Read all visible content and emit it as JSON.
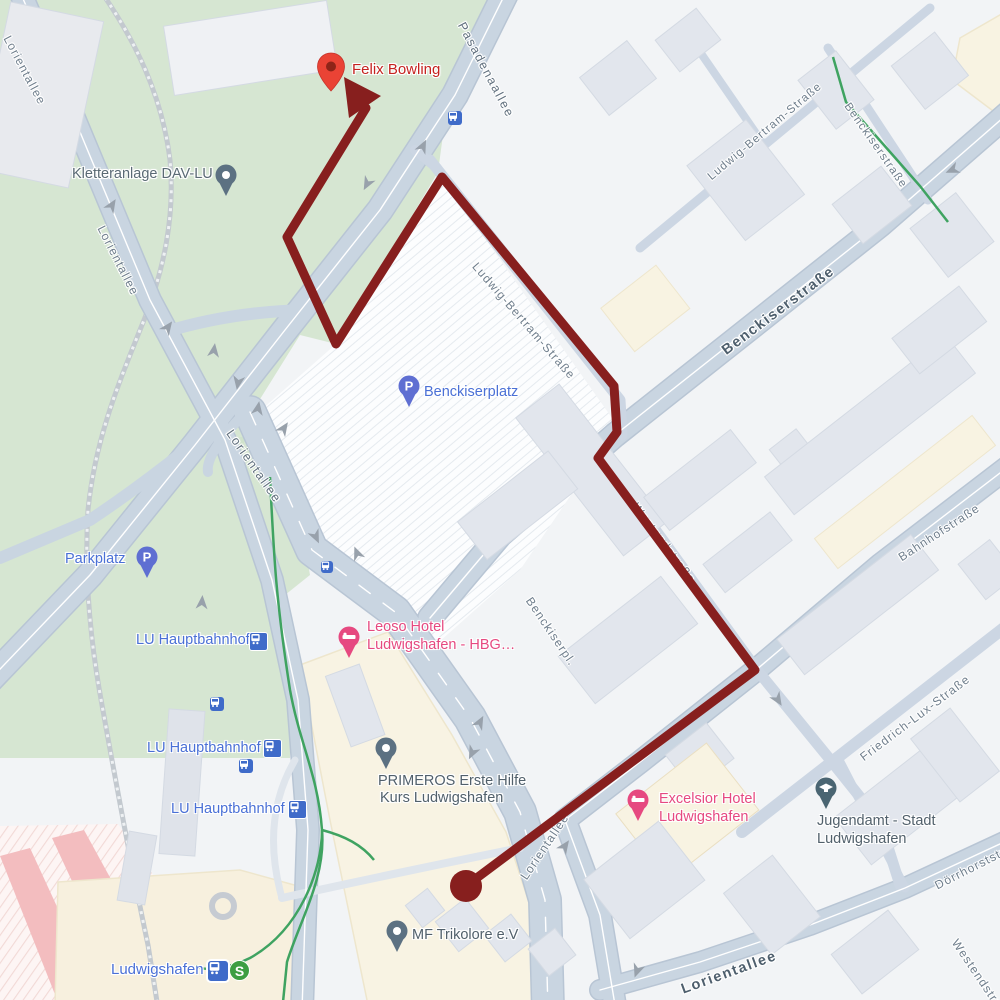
{
  "map_type": "google-maps-route-view",
  "colors": {
    "route": "#871f1e",
    "pin-red": "#ea4335",
    "pin-red-inner": "#8e2418",
    "poi-blue": "#4a70d6",
    "poi-pink": "#e64980",
    "parking-pin": "#5f6fd2",
    "slate-pin": "#5c7182",
    "jugendamt-pin": "#4a6572",
    "transit-blue": "#3f6bc9",
    "sbahn": "#3d9e42",
    "park": "#d6e6d2",
    "road": "#c9d5e1",
    "cream": "#f8f3e3",
    "green-path": "#3fa361"
  },
  "route": {
    "destination": "Felix Bowling",
    "stroke_width": 9,
    "points": [
      [
        466,
        886
      ],
      [
        755,
        670
      ],
      [
        598,
        458
      ],
      [
        617,
        432
      ],
      [
        614,
        386
      ],
      [
        442,
        177
      ],
      [
        336,
        344
      ],
      [
        287,
        237
      ],
      [
        366,
        108
      ]
    ]
  },
  "streets": {
    "lorientallee": "Lorientallee",
    "pasadenaallee": "Pasadenaallee",
    "ludwig_bertram": "Ludwig-Bertram-Straße",
    "benckiserstrasse": "Benckiserstraße",
    "westendstrasse": "Westendstraße",
    "bahnhofstrasse": "Bahnhofstraße",
    "friedrich_lux": "Friedrich-Lux-Straße",
    "doerrhorststrasse": "Dörrhorststraße",
    "benckiserplatz_short": "Benckiserpl."
  },
  "pois": {
    "felix_bowling": "Felix Bowling",
    "kletteranlage": "Kletteranlage DAV-LU",
    "benckiserplatz": "Benckiserplatz",
    "parkplatz": "Parkplatz",
    "lu_hauptbahnhof": "LU Hauptbahnhof",
    "leoso_line1": "Leoso Hotel",
    "leoso_line2": "Ludwigshafen -  HBG…",
    "primeros_line1": "PRIMEROS Erste Hilfe",
    "primeros_line2": "Kurs Ludwigshafen",
    "excelsior_line1": "Excelsior Hotel",
    "excelsior_line2": "Ludwigshafen",
    "jugendamt_line1": "Jugendamt - Stadt",
    "jugendamt_line2": "Ludwigshafen",
    "mf_trikolore": "MF Trikolore e.V",
    "ludwigshafen_station": "Ludwigshafen"
  },
  "icon_glyphs": {
    "parking": "P",
    "sbahn": "S"
  }
}
